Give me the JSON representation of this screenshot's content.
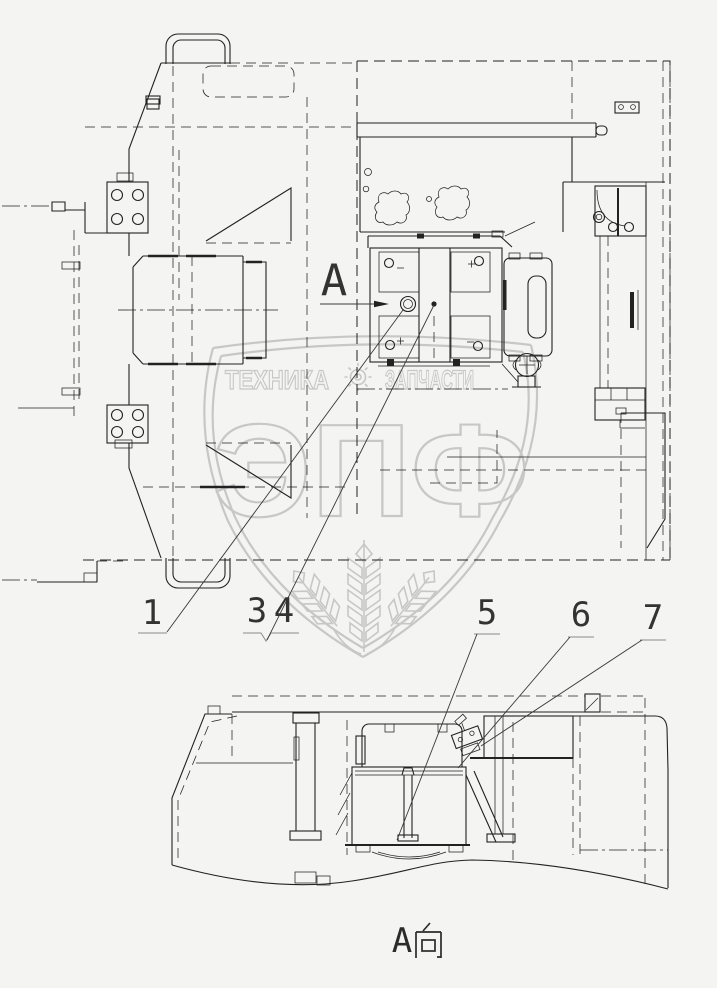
{
  "colors": {
    "background": "#f4f4f2",
    "line": "#222222",
    "watermark": "#c7c7c7",
    "leader": "#3a3a3a"
  },
  "top_view": {
    "section_marker": "A",
    "callouts": [
      {
        "label": "1"
      },
      {
        "label": "3"
      },
      {
        "label": "4"
      }
    ]
  },
  "section_view": {
    "view_title": "A向",
    "marker_prefix": "A",
    "callouts": [
      {
        "label": "5"
      },
      {
        "label": "6"
      },
      {
        "label": "7"
      }
    ]
  },
  "watermark": {
    "banner_left": "ТЕХНИКА",
    "banner_right": "ЗАПЧАСТИ",
    "logo_text": "ЭПФ",
    "gear_icon": "gear-icon",
    "emblem_icon": "shield-wheat-icon"
  }
}
